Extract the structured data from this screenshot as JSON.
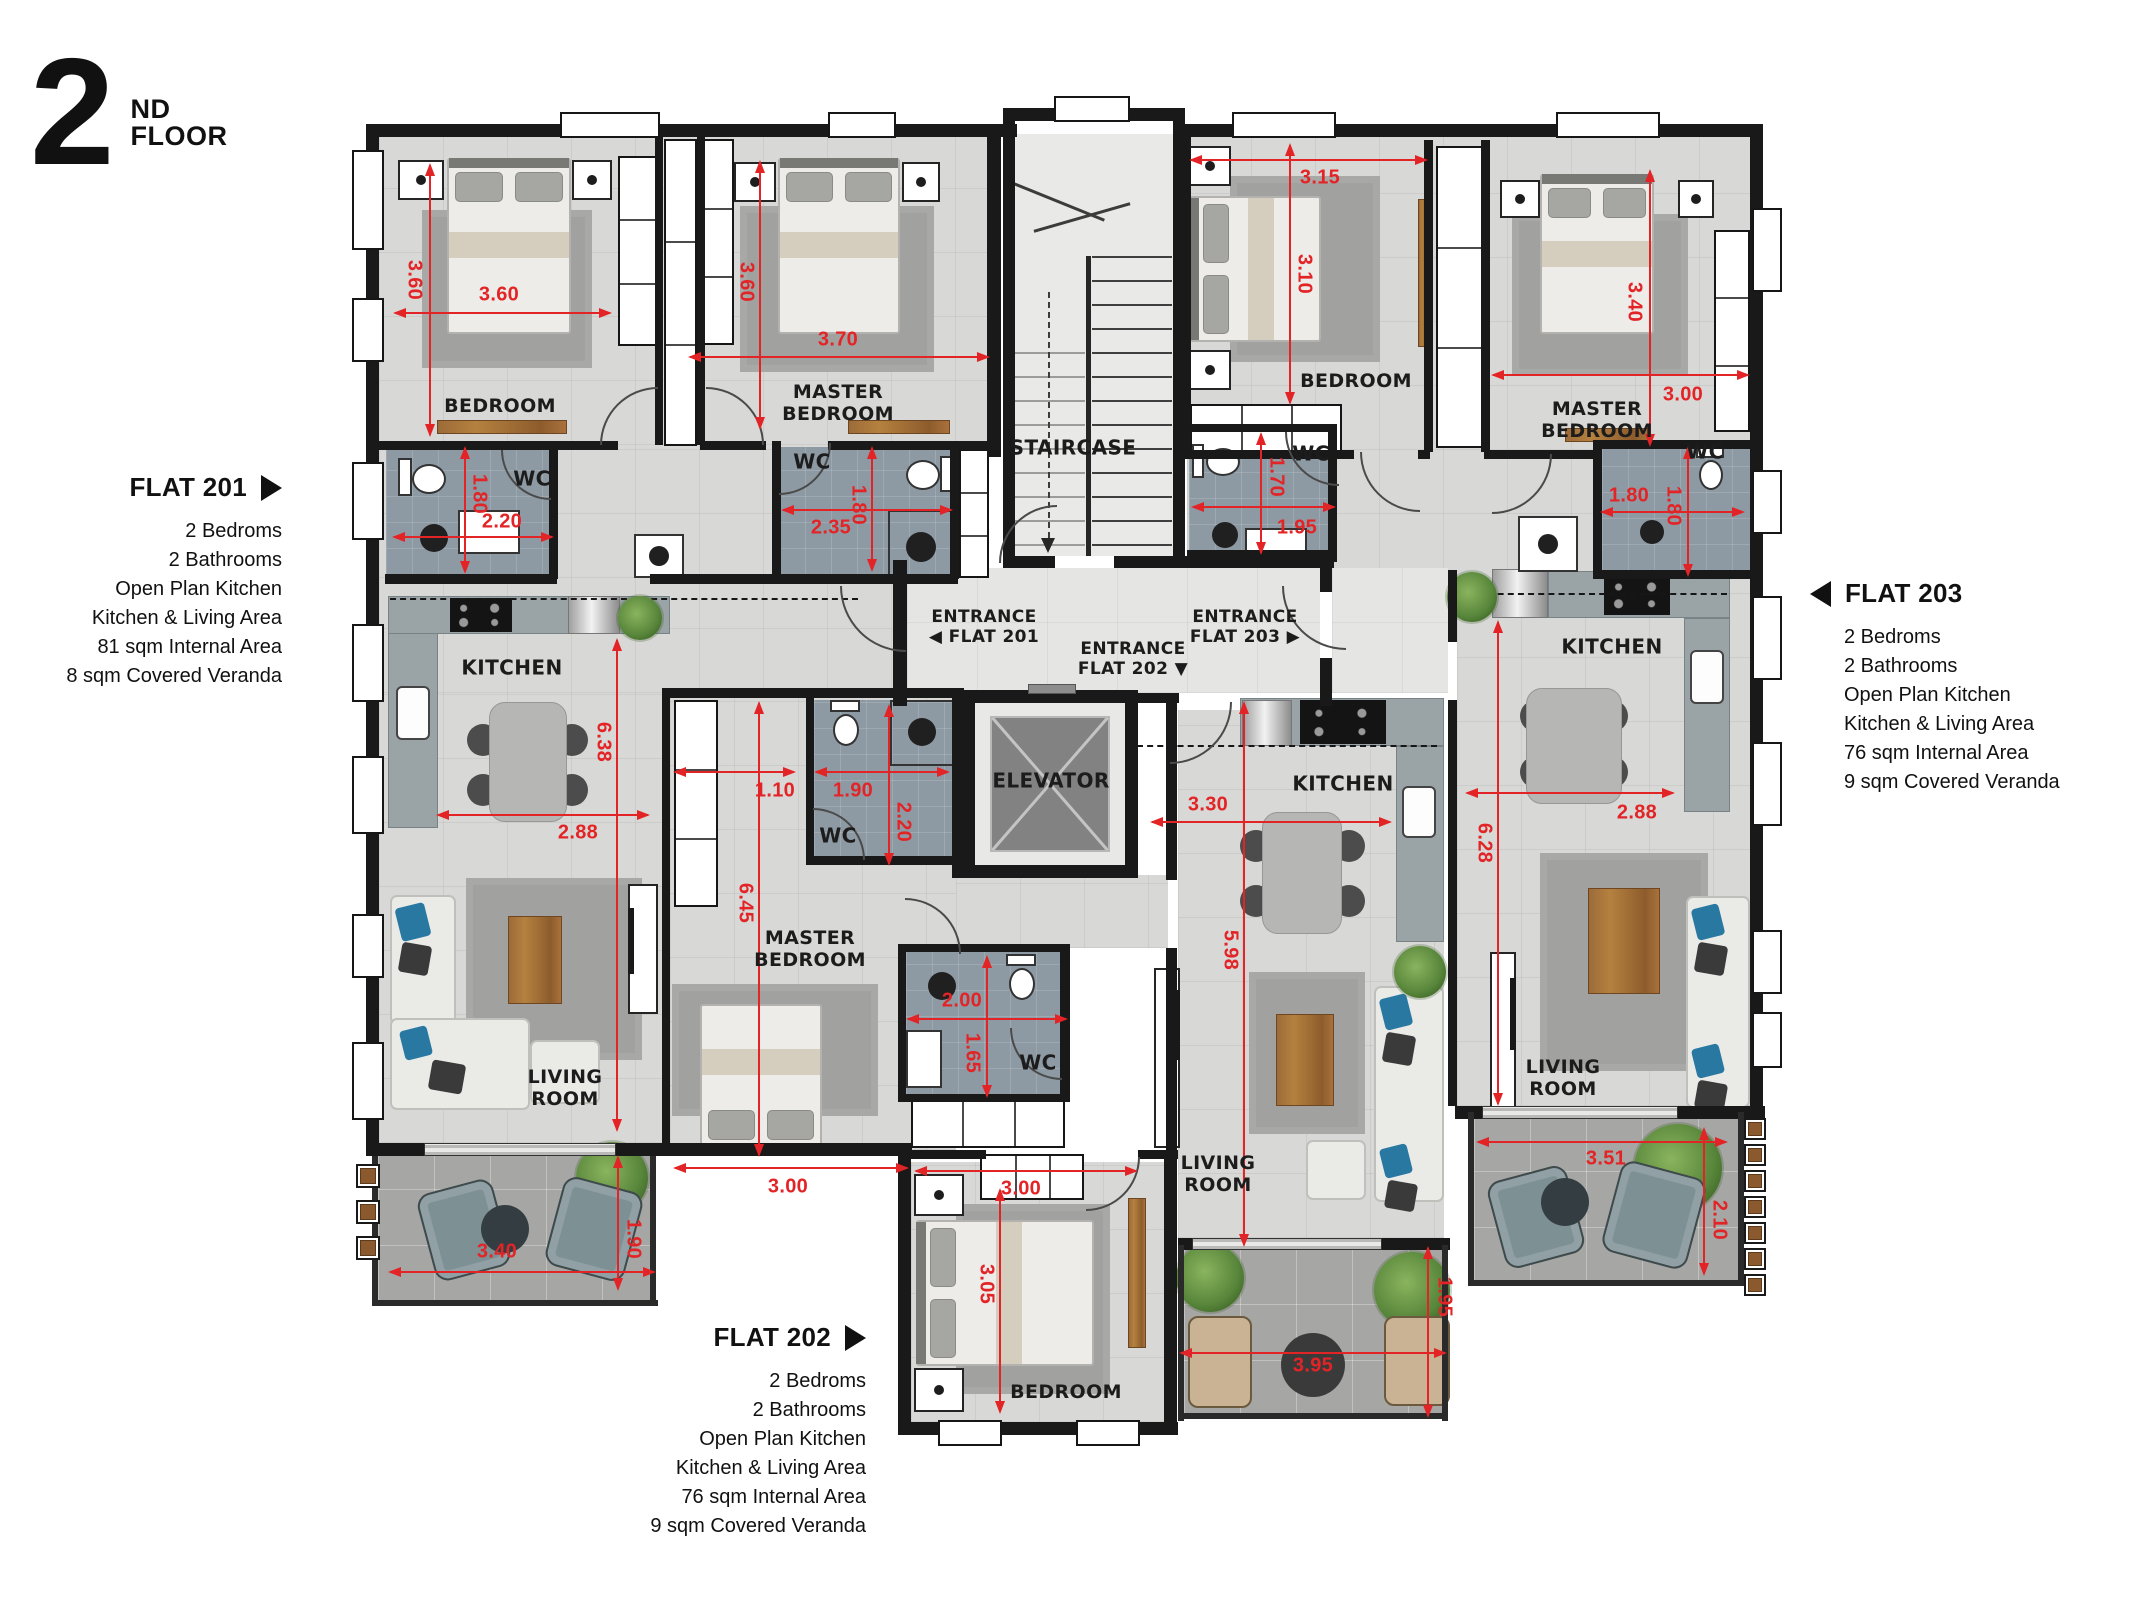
{
  "title": {
    "number": "2",
    "suffix": "ND",
    "word": "FLOOR"
  },
  "flats": {
    "flat201": {
      "name": "FLAT 201",
      "arrow": "right",
      "details": [
        "2 Bedroms",
        "2 Bathrooms",
        "Open Plan Kitchen",
        "Kitchen & Living Area",
        "81 sqm Internal Area",
        "8 sqm Covered Veranda"
      ]
    },
    "flat202": {
      "name": "FLAT 202",
      "arrow": "right",
      "details": [
        "2 Bedroms",
        "2 Bathrooms",
        "Open Plan Kitchen",
        "Kitchen & Living Area",
        "76 sqm Internal Area",
        "9 sqm Covered Veranda"
      ]
    },
    "flat203": {
      "name": "FLAT 203",
      "arrow": "left",
      "details": [
        "2 Bedroms",
        "2 Bathrooms",
        "Open Plan Kitchen",
        "Kitchen & Living Area",
        "76 sqm Internal Area",
        "9 sqm Covered Veranda"
      ]
    }
  },
  "room_labels": [
    {
      "lines": [
        "BEDROOM"
      ],
      "x": 500,
      "y": 406,
      "s": 19
    },
    {
      "lines": [
        "MASTER",
        "BEDROOM"
      ],
      "x": 838,
      "y": 403,
      "s": 19
    },
    {
      "lines": [
        "WC"
      ],
      "x": 532,
      "y": 479,
      "s": 20
    },
    {
      "lines": [
        "WC"
      ],
      "x": 812,
      "y": 462,
      "s": 20
    },
    {
      "lines": [
        "STAIRCASE"
      ],
      "x": 1073,
      "y": 448,
      "s": 20
    },
    {
      "lines": [
        "BEDROOM"
      ],
      "x": 1356,
      "y": 381,
      "s": 19
    },
    {
      "lines": [
        "MASTER",
        "BEDROOM"
      ],
      "x": 1597,
      "y": 420,
      "s": 19
    },
    {
      "lines": [
        "WC"
      ],
      "x": 1311,
      "y": 454,
      "s": 20
    },
    {
      "lines": [
        "WC"
      ],
      "x": 1705,
      "y": 452,
      "s": 20
    },
    {
      "lines": [
        "KITCHEN"
      ],
      "x": 512,
      "y": 668,
      "s": 20
    },
    {
      "lines": [
        "ENTRANCE",
        "◀ FLAT 201"
      ],
      "x": 984,
      "y": 627,
      "s": 17
    },
    {
      "lines": [
        "ENTRANCE",
        "FLAT 202 ▼"
      ],
      "x": 1133,
      "y": 659,
      "s": 17
    },
    {
      "lines": [
        "ENTRANCE",
        "FLAT 203 ▶"
      ],
      "x": 1245,
      "y": 627,
      "s": 17
    },
    {
      "lines": [
        "ELEVATOR"
      ],
      "x": 1051,
      "y": 781,
      "s": 20
    },
    {
      "lines": [
        "WC"
      ],
      "x": 838,
      "y": 836,
      "s": 20
    },
    {
      "lines": [
        "MASTER",
        "BEDROOM"
      ],
      "x": 810,
      "y": 949,
      "s": 19
    },
    {
      "lines": [
        "KITCHEN"
      ],
      "x": 1343,
      "y": 784,
      "s": 20
    },
    {
      "lines": [
        "KITCHEN"
      ],
      "x": 1612,
      "y": 647,
      "s": 20
    },
    {
      "lines": [
        "WC"
      ],
      "x": 1038,
      "y": 1063,
      "s": 20
    },
    {
      "lines": [
        "LIVING",
        "ROOM"
      ],
      "x": 565,
      "y": 1088,
      "s": 19
    },
    {
      "lines": [
        "LIVING",
        "ROOM"
      ],
      "x": 1218,
      "y": 1174,
      "s": 19
    },
    {
      "lines": [
        "LIVING",
        "ROOM"
      ],
      "x": 1563,
      "y": 1078,
      "s": 19
    },
    {
      "lines": [
        "BEDROOM"
      ],
      "x": 1066,
      "y": 1392,
      "s": 19
    }
  ],
  "dimensions": [
    {
      "t": "3.60",
      "o": "v",
      "x": 430,
      "y": 165,
      "l": 270,
      "lx": 414,
      "ly": 280
    },
    {
      "t": "3.60",
      "o": "h",
      "x": 395,
      "y": 313,
      "l": 215,
      "lx": 499,
      "ly": 295
    },
    {
      "t": "3.60",
      "o": "v",
      "x": 760,
      "y": 162,
      "l": 266,
      "lx": 746,
      "ly": 282
    },
    {
      "t": "3.70",
      "o": "h",
      "x": 690,
      "y": 357,
      "l": 298,
      "lx": 838,
      "ly": 340
    },
    {
      "t": "1.80",
      "o": "v",
      "x": 465,
      "y": 448,
      "l": 124,
      "lx": 479,
      "ly": 494
    },
    {
      "t": "2.20",
      "o": "h",
      "x": 394,
      "y": 537,
      "l": 158,
      "lx": 502,
      "ly": 522
    },
    {
      "t": "1.80",
      "o": "v",
      "x": 872,
      "y": 448,
      "l": 122,
      "lx": 858,
      "ly": 505
    },
    {
      "t": "2.35",
      "o": "h",
      "x": 783,
      "y": 510,
      "l": 168,
      "lx": 831,
      "ly": 528
    },
    {
      "t": "6.38",
      "o": "v",
      "x": 617,
      "y": 640,
      "l": 490,
      "lx": 603,
      "ly": 742
    },
    {
      "t": "2.88",
      "o": "h",
      "x": 438,
      "y": 815,
      "l": 210,
      "lx": 578,
      "ly": 833
    },
    {
      "t": "3.40",
      "o": "h",
      "x": 390,
      "y": 1272,
      "l": 264,
      "lx": 497,
      "ly": 1252
    },
    {
      "t": "1.90",
      "o": "v",
      "x": 618,
      "y": 1157,
      "l": 132,
      "lx": 633,
      "ly": 1239
    },
    {
      "t": "1.10",
      "o": "h",
      "x": 675,
      "y": 772,
      "l": 119,
      "lx": 775,
      "ly": 791
    },
    {
      "t": "1.90",
      "o": "h",
      "x": 816,
      "y": 772,
      "l": 132,
      "lx": 853,
      "ly": 791
    },
    {
      "t": "2.20",
      "o": "v",
      "x": 889,
      "y": 706,
      "l": 158,
      "lx": 903,
      "ly": 822
    },
    {
      "t": "6.45",
      "o": "v",
      "x": 759,
      "y": 703,
      "l": 452,
      "lx": 745,
      "ly": 903
    },
    {
      "t": "3.00",
      "o": "h",
      "x": 675,
      "y": 1168,
      "l": 232,
      "lx": 788,
      "ly": 1187
    },
    {
      "t": "3.00",
      "o": "h",
      "x": 916,
      "y": 1171,
      "l": 220,
      "lx": 1021,
      "ly": 1189
    },
    {
      "t": "3.05",
      "o": "v",
      "x": 1000,
      "y": 1190,
      "l": 222,
      "lx": 986,
      "ly": 1284
    },
    {
      "t": "2.00",
      "o": "h",
      "x": 908,
      "y": 1019,
      "l": 158,
      "lx": 962,
      "ly": 1001
    },
    {
      "t": "1.65",
      "o": "v",
      "x": 987,
      "y": 957,
      "l": 139,
      "lx": 972,
      "ly": 1053
    },
    {
      "t": "3.30",
      "o": "h",
      "x": 1152,
      "y": 822,
      "l": 238,
      "lx": 1208,
      "ly": 805
    },
    {
      "t": "5.98",
      "o": "v",
      "x": 1244,
      "y": 703,
      "l": 542,
      "lx": 1230,
      "ly": 950
    },
    {
      "t": "3.95",
      "o": "h",
      "x": 1181,
      "y": 1353,
      "l": 264,
      "lx": 1313,
      "ly": 1366
    },
    {
      "t": "1.95",
      "o": "v",
      "x": 1428,
      "y": 1248,
      "l": 168,
      "lx": 1444,
      "ly": 1297
    },
    {
      "t": "3.15",
      "o": "h",
      "x": 1191,
      "y": 160,
      "l": 235,
      "lx": 1320,
      "ly": 178
    },
    {
      "t": "3.10",
      "o": "v",
      "x": 1290,
      "y": 145,
      "l": 258,
      "lx": 1304,
      "ly": 274
    },
    {
      "t": "3.40",
      "o": "v",
      "x": 1650,
      "y": 171,
      "l": 274,
      "lx": 1634,
      "ly": 302
    },
    {
      "t": "3.00",
      "o": "h",
      "x": 1493,
      "y": 375,
      "l": 255,
      "lx": 1683,
      "ly": 395
    },
    {
      "t": "1.70",
      "o": "v",
      "x": 1261,
      "y": 434,
      "l": 119,
      "lx": 1276,
      "ly": 477
    },
    {
      "t": "1.95",
      "o": "h",
      "x": 1193,
      "y": 507,
      "l": 141,
      "lx": 1297,
      "ly": 528
    },
    {
      "t": "1.80",
      "o": "h",
      "x": 1602,
      "y": 512,
      "l": 141,
      "lx": 1629,
      "ly": 496
    },
    {
      "t": "1.80",
      "o": "v",
      "x": 1688,
      "y": 448,
      "l": 127,
      "lx": 1673,
      "ly": 506
    },
    {
      "t": "6.28",
      "o": "v",
      "x": 1498,
      "y": 622,
      "l": 482,
      "lx": 1484,
      "ly": 843
    },
    {
      "t": "2.88",
      "o": "h",
      "x": 1467,
      "y": 793,
      "l": 206,
      "lx": 1637,
      "ly": 813
    },
    {
      "t": "3.51",
      "o": "h",
      "x": 1478,
      "y": 1142,
      "l": 248,
      "lx": 1606,
      "ly": 1159
    },
    {
      "t": "2.10",
      "o": "v",
      "x": 1704,
      "y": 1129,
      "l": 145,
      "lx": 1719,
      "ly": 1220
    }
  ],
  "colors": {
    "dimension": "#e32427",
    "wall": "#191919",
    "wc_floor": "#8d9aa3",
    "floor": "#d8d8d6",
    "veranda": "#a6a6a4",
    "wood": "#a9713c",
    "accent": "#2878a2"
  }
}
